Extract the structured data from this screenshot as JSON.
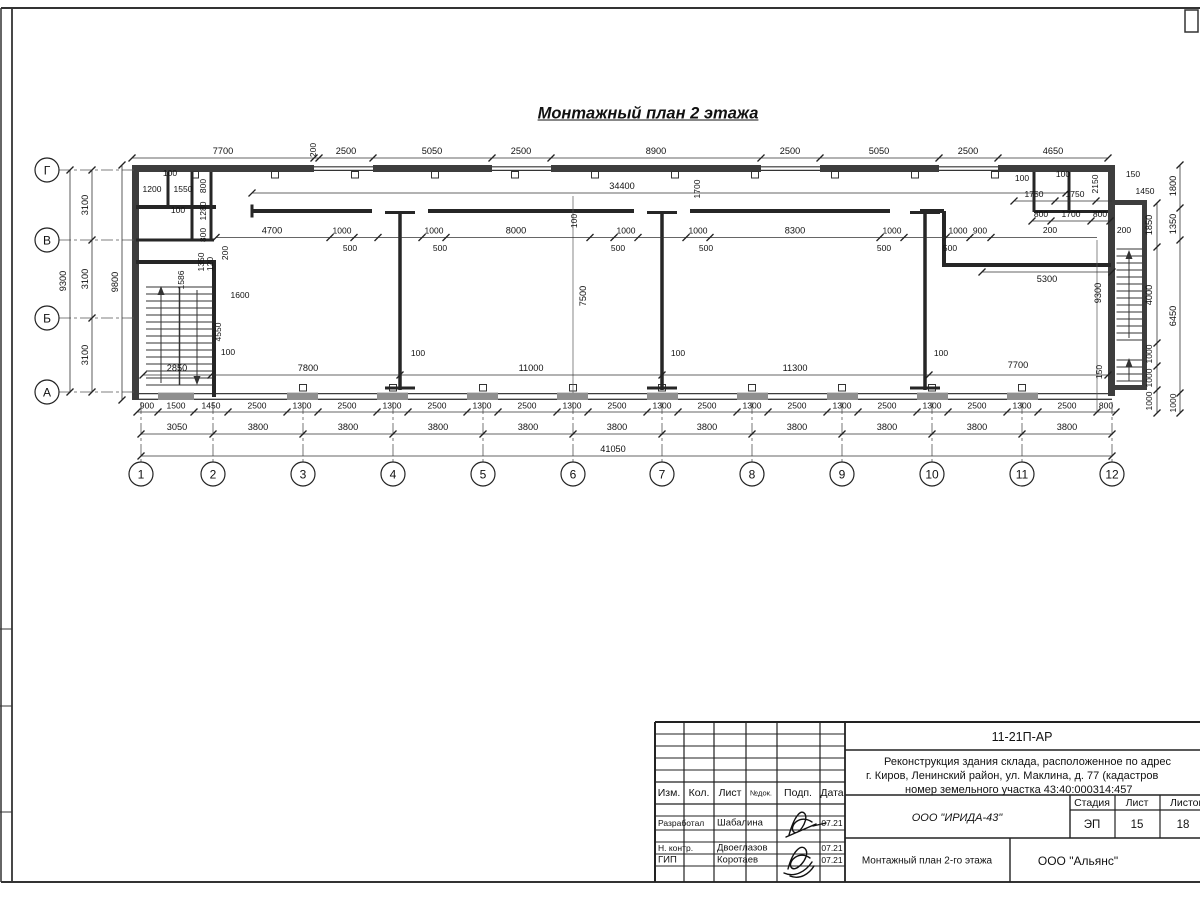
{
  "sheet": {
    "title": "Монтажный план 2 этажа"
  },
  "titleblock": {
    "doc_code": "11-21П-АР",
    "project_line1": "Реконструкция здания склада, расположенное по адрес",
    "project_line2": "г. Киров, Ленинский район, ул. Маклина, д. 77 (кадастров",
    "project_line3": "номер земельного участка 43:40:000314:457",
    "col_izm": "Изм.",
    "col_kol": "Кол.",
    "col_list": "Лист",
    "col_ndoc": "№док.",
    "col_podp": "Подп.",
    "col_data": "Дата",
    "row1_role": "Разработал",
    "row1_name": "Шабалина",
    "row1_date": "07.21",
    "row2_role": "Н. контр.",
    "row2_name": "Двоеглазов",
    "row2_date": "07.21",
    "row3_role": "ГИП",
    "row3_name": "Коротаев",
    "row3_date": "07.21",
    "org_design": "ООО \"ИРИДА-43\"",
    "stage_h": "Стадия",
    "sheet_h": "Лист",
    "sheets_h": "Листов",
    "stage_v": "ЭП",
    "sheet_v": "15",
    "sheets_v": "18",
    "drawing_name": "Монтажный план 2-го этажа",
    "org_customer": "ООО \"Альянс\""
  },
  "plan": {
    "axes": {
      "rows": [
        {
          "label": "Г",
          "y": 170
        },
        {
          "label": "В",
          "y": 240
        },
        {
          "label": "Б",
          "y": 318
        },
        {
          "label": "А",
          "y": 392
        }
      ],
      "cols": [
        {
          "label": "1",
          "x": 141
        },
        {
          "label": "2",
          "x": 213
        },
        {
          "label": "3",
          "x": 303
        },
        {
          "label": "4",
          "x": 393
        },
        {
          "label": "5",
          "x": 483
        },
        {
          "label": "6",
          "x": 573
        },
        {
          "label": "7",
          "x": 662
        },
        {
          "label": "8",
          "x": 752
        },
        {
          "label": "9",
          "x": 842
        },
        {
          "label": "10",
          "x": 932
        },
        {
          "label": "11",
          "x": 1022
        },
        {
          "label": "12",
          "x": 1112
        }
      ]
    },
    "dims": [
      {
        "d": "h",
        "y": 158,
        "x1": 132,
        "x2": 1108,
        "t": [
          132,
          314,
          319,
          373,
          492,
          551,
          761,
          820,
          939,
          998,
          1108
        ]
      },
      {
        "d": "h",
        "y": 412,
        "x1": 137,
        "x2": 1116,
        "t": [
          137,
          158,
          194,
          228,
          287,
          318,
          377,
          408,
          467,
          498,
          557,
          588,
          647,
          678,
          737,
          768,
          827,
          858,
          917,
          948,
          1007,
          1038,
          1097,
          1116
        ]
      },
      {
        "d": "h",
        "y": 434,
        "x1": 141,
        "x2": 1112,
        "t": [
          141,
          213,
          303,
          393,
          483,
          573,
          662,
          752,
          842,
          932,
          1022,
          1112
        ]
      },
      {
        "d": "h",
        "y": 456,
        "x1": 141,
        "x2": 1112,
        "t": [
          141,
          1112
        ]
      },
      {
        "d": "h",
        "y": 237.5,
        "x1": 216,
        "x2": 1097,
        "t": [
          216,
          330,
          354,
          378,
          422,
          446,
          590,
          614,
          638,
          686,
          710,
          880,
          904,
          946,
          970,
          991
        ]
      },
      {
        "d": "h",
        "y": 375,
        "x1": 143,
        "x2": 1108,
        "t": [
          143,
          211,
          400,
          662,
          929,
          1108
        ]
      },
      {
        "d": "h",
        "y": 193,
        "x1": 252,
        "x2": 1066,
        "t": [
          252,
          1066
        ]
      },
      {
        "d": "h",
        "y": 272,
        "x1": 982,
        "x2": 1112,
        "t": [
          982,
          1112
        ]
      },
      {
        "d": "h",
        "y": 201,
        "x1": 1014,
        "x2": 1112,
        "t": [
          1014,
          1055,
          1096
        ]
      },
      {
        "d": "h",
        "y": 221,
        "x1": 1032,
        "x2": 1110,
        "t": [
          1032,
          1051,
          1091,
          1110
        ]
      },
      {
        "d": "v",
        "x": 70,
        "y1": 170,
        "y2": 392,
        "t": [
          170,
          392
        ]
      },
      {
        "d": "v",
        "x": 92,
        "y1": 170,
        "y2": 392,
        "t": [
          170,
          240,
          318,
          392
        ]
      },
      {
        "d": "v",
        "x": 122,
        "y1": 165,
        "y2": 400,
        "t": [
          165,
          400
        ]
      },
      {
        "d": "v",
        "x": 1157,
        "y1": 203,
        "y2": 413,
        "t": [
          203,
          247,
          343,
          366,
          390,
          413
        ]
      },
      {
        "d": "v",
        "x": 1180,
        "y1": 165,
        "y2": 413,
        "t": [
          165,
          208,
          240,
          393,
          413
        ]
      }
    ],
    "labels": [
      {
        "t": "7700",
        "x": 223,
        "y": 154
      },
      {
        "t": "2500",
        "x": 346,
        "y": 154
      },
      {
        "t": "5050",
        "x": 432,
        "y": 154
      },
      {
        "t": "2500",
        "x": 521,
        "y": 154
      },
      {
        "t": "8900",
        "x": 656,
        "y": 154
      },
      {
        "t": "2500",
        "x": 790,
        "y": 154
      },
      {
        "t": "5050",
        "x": 879,
        "y": 154
      },
      {
        "t": "2500",
        "x": 968,
        "y": 154
      },
      {
        "t": "4650",
        "x": 1053,
        "y": 154
      },
      {
        "t": "200",
        "x": 316,
        "y": 150,
        "r": 1,
        "s": 8.5
      },
      {
        "t": "900",
        "x": 147,
        "y": 408.5,
        "s": 8.5
      },
      {
        "t": "1500",
        "x": 176,
        "y": 408.5,
        "s": 8.5
      },
      {
        "t": "1450",
        "x": 211,
        "y": 408.5,
        "s": 8.5
      },
      {
        "t": "2500",
        "x": 257,
        "y": 408.5,
        "s": 8.5
      },
      {
        "t": "1300",
        "x": 302,
        "y": 408.5,
        "s": 8.5
      },
      {
        "t": "2500",
        "x": 347,
        "y": 408.5,
        "s": 8.5
      },
      {
        "t": "1300",
        "x": 392,
        "y": 408.5,
        "s": 8.5
      },
      {
        "t": "2500",
        "x": 437,
        "y": 408.5,
        "s": 8.5
      },
      {
        "t": "1300",
        "x": 482,
        "y": 408.5,
        "s": 8.5
      },
      {
        "t": "2500",
        "x": 527,
        "y": 408.5,
        "s": 8.5
      },
      {
        "t": "1300",
        "x": 572,
        "y": 408.5,
        "s": 8.5
      },
      {
        "t": "2500",
        "x": 617,
        "y": 408.5,
        "s": 8.5
      },
      {
        "t": "1300",
        "x": 662,
        "y": 408.5,
        "s": 8.5
      },
      {
        "t": "2500",
        "x": 707,
        "y": 408.5,
        "s": 8.5
      },
      {
        "t": "1300",
        "x": 752,
        "y": 408.5,
        "s": 8.5
      },
      {
        "t": "2500",
        "x": 797,
        "y": 408.5,
        "s": 8.5
      },
      {
        "t": "1300",
        "x": 842,
        "y": 408.5,
        "s": 8.5
      },
      {
        "t": "2500",
        "x": 887,
        "y": 408.5,
        "s": 8.5
      },
      {
        "t": "1300",
        "x": 932,
        "y": 408.5,
        "s": 8.5
      },
      {
        "t": "2500",
        "x": 977,
        "y": 408.5,
        "s": 8.5
      },
      {
        "t": "1300",
        "x": 1022,
        "y": 408.5,
        "s": 8.5
      },
      {
        "t": "2500",
        "x": 1067,
        "y": 408.5,
        "s": 8.5
      },
      {
        "t": "800",
        "x": 1106,
        "y": 408.5,
        "s": 8.5
      },
      {
        "t": "3050",
        "x": 177,
        "y": 430
      },
      {
        "t": "3800",
        "x": 258,
        "y": 430
      },
      {
        "t": "3800",
        "x": 348,
        "y": 430
      },
      {
        "t": "3800",
        "x": 438,
        "y": 430
      },
      {
        "t": "3800",
        "x": 528,
        "y": 430
      },
      {
        "t": "3800",
        "x": 617,
        "y": 430
      },
      {
        "t": "3800",
        "x": 707,
        "y": 430
      },
      {
        "t": "3800",
        "x": 797,
        "y": 430
      },
      {
        "t": "3800",
        "x": 887,
        "y": 430
      },
      {
        "t": "3800",
        "x": 977,
        "y": 430
      },
      {
        "t": "3800",
        "x": 1067,
        "y": 430
      },
      {
        "t": "41050",
        "x": 613,
        "y": 452
      },
      {
        "t": "9300",
        "x": 66,
        "y": 281,
        "r": 1
      },
      {
        "t": "3100",
        "x": 88,
        "y": 205,
        "r": 1
      },
      {
        "t": "3100",
        "x": 88,
        "y": 279,
        "r": 1
      },
      {
        "t": "3100",
        "x": 88,
        "y": 355,
        "r": 1
      },
      {
        "t": "9800",
        "x": 118,
        "y": 282,
        "r": 1
      },
      {
        "t": "1850",
        "x": 1152,
        "y": 225,
        "r": 1
      },
      {
        "t": "4000",
        "x": 1152,
        "y": 295,
        "r": 1
      },
      {
        "t": "1000",
        "x": 1152,
        "y": 354,
        "r": 1,
        "s": 8.5
      },
      {
        "t": "1000",
        "x": 1152,
        "y": 378,
        "r": 1,
        "s": 8.5
      },
      {
        "t": "1000",
        "x": 1152,
        "y": 401,
        "r": 1,
        "s": 8.5
      },
      {
        "t": "1800",
        "x": 1176,
        "y": 186,
        "r": 1
      },
      {
        "t": "1350",
        "x": 1176,
        "y": 224,
        "r": 1
      },
      {
        "t": "6450",
        "x": 1176,
        "y": 316,
        "r": 1
      },
      {
        "t": "1000",
        "x": 1176,
        "y": 403,
        "r": 1,
        "s": 8.5
      },
      {
        "t": "4700",
        "x": 272,
        "y": 233.5
      },
      {
        "t": "1000",
        "x": 342,
        "y": 233.5,
        "s": 8.5
      },
      {
        "t": "1000",
        "x": 434,
        "y": 233.5,
        "s": 8.5
      },
      {
        "t": "8000",
        "x": 516,
        "y": 233.5
      },
      {
        "t": "1000",
        "x": 626,
        "y": 233.5,
        "s": 8.5
      },
      {
        "t": "1000",
        "x": 698,
        "y": 233.5,
        "s": 8.5
      },
      {
        "t": "8300",
        "x": 795,
        "y": 233.5
      },
      {
        "t": "1000",
        "x": 892,
        "y": 233.5,
        "s": 8.5
      },
      {
        "t": "1000",
        "x": 958,
        "y": 233.5,
        "s": 8.5
      },
      {
        "t": "900",
        "x": 980,
        "y": 233.5,
        "s": 8.5
      },
      {
        "t": "500",
        "x": 350,
        "y": 251,
        "s": 8.5
      },
      {
        "t": "500",
        "x": 440,
        "y": 251,
        "s": 8.5
      },
      {
        "t": "500",
        "x": 618,
        "y": 251,
        "s": 8.5
      },
      {
        "t": "500",
        "x": 706,
        "y": 251,
        "s": 8.5
      },
      {
        "t": "500",
        "x": 884,
        "y": 251,
        "s": 8.5
      },
      {
        "t": "500",
        "x": 950,
        "y": 251,
        "s": 8.5
      },
      {
        "t": "2850",
        "x": 177,
        "y": 371
      },
      {
        "t": "7800",
        "x": 308,
        "y": 371
      },
      {
        "t": "11000",
        "x": 531,
        "y": 371
      },
      {
        "t": "11300",
        "x": 795,
        "y": 371
      },
      {
        "t": "7700",
        "x": 1018,
        "y": 368
      },
      {
        "t": "150",
        "x": 1102,
        "y": 372,
        "r": 1,
        "s": 8.5
      },
      {
        "t": "100",
        "x": 228,
        "y": 355,
        "s": 8.5
      },
      {
        "t": "100",
        "x": 418,
        "y": 356,
        "s": 8.5
      },
      {
        "t": "100",
        "x": 678,
        "y": 356,
        "s": 8.5
      },
      {
        "t": "100",
        "x": 941,
        "y": 356,
        "s": 8.5
      },
      {
        "t": "34400",
        "x": 622,
        "y": 189
      },
      {
        "t": "1700",
        "x": 700,
        "y": 189,
        "r": 1,
        "s": 8.5
      },
      {
        "t": "100",
        "x": 577,
        "y": 221,
        "r": 1,
        "s": 8.5
      },
      {
        "t": "7500",
        "x": 586,
        "y": 296,
        "r": 1
      },
      {
        "t": "9300",
        "x": 1101,
        "y": 293,
        "r": 1
      },
      {
        "t": "5300",
        "x": 1047,
        "y": 282
      },
      {
        "t": "1750",
        "x": 1034,
        "y": 197,
        "s": 8.5
      },
      {
        "t": "1750",
        "x": 1075,
        "y": 197,
        "s": 8.5
      },
      {
        "t": "100",
        "x": 1022,
        "y": 181,
        "s": 8.5
      },
      {
        "t": "100",
        "x": 1063,
        "y": 177,
        "s": 8.5
      },
      {
        "t": "150",
        "x": 1133,
        "y": 177,
        "s": 8.5
      },
      {
        "t": "2150",
        "x": 1098,
        "y": 184,
        "r": 1,
        "s": 8.5
      },
      {
        "t": "1450",
        "x": 1145,
        "y": 194,
        "s": 8.5
      },
      {
        "t": "800",
        "x": 1041,
        "y": 217,
        "s": 8.5
      },
      {
        "t": "1700",
        "x": 1071,
        "y": 217,
        "s": 8.5
      },
      {
        "t": "800",
        "x": 1100,
        "y": 217,
        "s": 8.5
      },
      {
        "t": "200",
        "x": 1050,
        "y": 233,
        "s": 8.5
      },
      {
        "t": "200",
        "x": 1124,
        "y": 233,
        "s": 8.5
      },
      {
        "t": "1200",
        "x": 152,
        "y": 192,
        "s": 8.5
      },
      {
        "t": "1550",
        "x": 183,
        "y": 192,
        "s": 8.5
      },
      {
        "t": "100",
        "x": 170,
        "y": 176,
        "s": 8.5
      },
      {
        "t": "100",
        "x": 178,
        "y": 213,
        "s": 8.5
      },
      {
        "t": "800",
        "x": 206,
        "y": 186,
        "r": 1,
        "s": 8.5
      },
      {
        "t": "1280",
        "x": 206,
        "y": 211,
        "r": 1,
        "s": 8.5
      },
      {
        "t": "800",
        "x": 206,
        "y": 235,
        "r": 1,
        "s": 8.5
      },
      {
        "t": "1350",
        "x": 204,
        "y": 262,
        "r": 1,
        "s": 8.5
      },
      {
        "t": "120",
        "x": 213,
        "y": 264,
        "r": 1,
        "s": 8.5
      },
      {
        "t": "200",
        "x": 228,
        "y": 253,
        "r": 1,
        "s": 8.5
      },
      {
        "t": "1586",
        "x": 184,
        "y": 280,
        "r": 1,
        "s": 8.5
      },
      {
        "t": "1600",
        "x": 240,
        "y": 298,
        "s": 8.5
      },
      {
        "t": "4550",
        "x": 221,
        "y": 332,
        "r": 1,
        "s": 8.5
      }
    ]
  }
}
